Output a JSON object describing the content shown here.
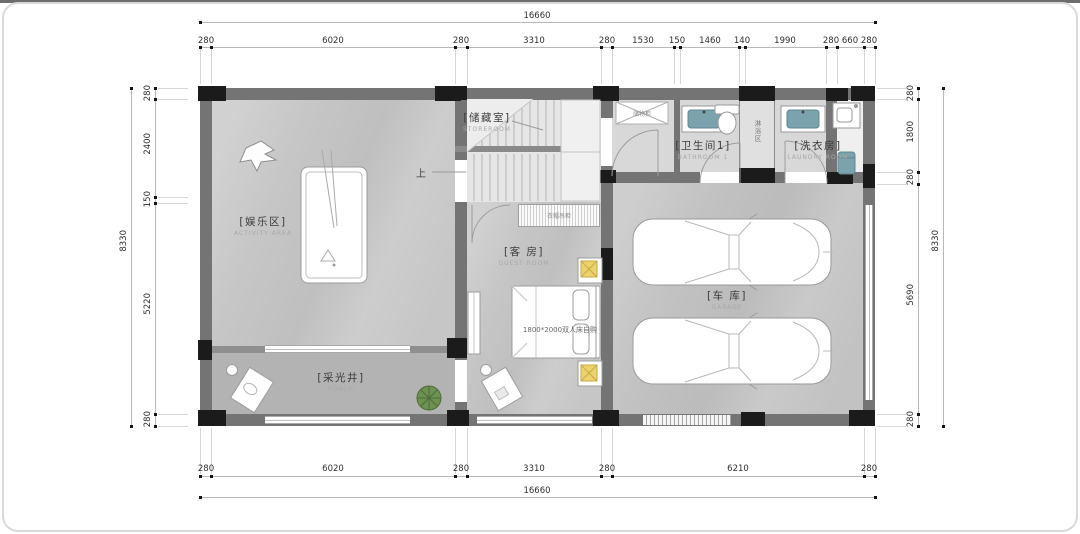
{
  "colors": {
    "wall": "#747474",
    "column": "#1b1b1b",
    "floor": "#c6c6c6",
    "floor_dark": "#b3b3b3",
    "floor_light": "#d8d8d8",
    "accent_teal": "#7ba3ad",
    "accent_yellow": "#ecd36b",
    "accent_green": "#6c9150"
  },
  "rooms": {
    "entertainment": {
      "cn": "[娱乐区]",
      "en": "ACTIVITY AREA"
    },
    "storage": {
      "cn": "[储藏室]",
      "en": "STOREROOM"
    },
    "bathroom1": {
      "cn": "[卫生间1]",
      "en": "BATHROOM 1"
    },
    "laundry": {
      "cn": "[洗衣房]",
      "en": "LAUNDRY ROOM"
    },
    "guest": {
      "cn": "[客 房]",
      "en": "GUEST ROOM"
    },
    "garage": {
      "cn": "[车 库]",
      "en": "GARAGE"
    },
    "lightwell": {
      "cn": "[采光井]",
      "en": "PORCH"
    },
    "shower": {
      "cn": "淋浴区"
    }
  },
  "annotations": {
    "up": "上",
    "entry_cabinet": "储物柜",
    "wardrobe": "衣帽吊柜",
    "bed": "1800*2000双人床自购"
  },
  "dims": {
    "top": {
      "overall": "16660",
      "segments": [
        "280",
        "6020",
        "280",
        "3310",
        "280",
        "1530",
        "150",
        "1460",
        "140",
        "1990",
        "280",
        "660",
        "280"
      ]
    },
    "bottom": {
      "overall": "16660",
      "segments": [
        "280",
        "6020",
        "280",
        "3310",
        "280",
        "6210",
        "280"
      ]
    },
    "left": {
      "overall": "8330",
      "segments": [
        "280",
        "2400",
        "150",
        "5220",
        "280"
      ]
    },
    "right": {
      "overall": "8330",
      "segments": [
        "280",
        "1800",
        "280",
        "5690",
        "280"
      ]
    }
  }
}
